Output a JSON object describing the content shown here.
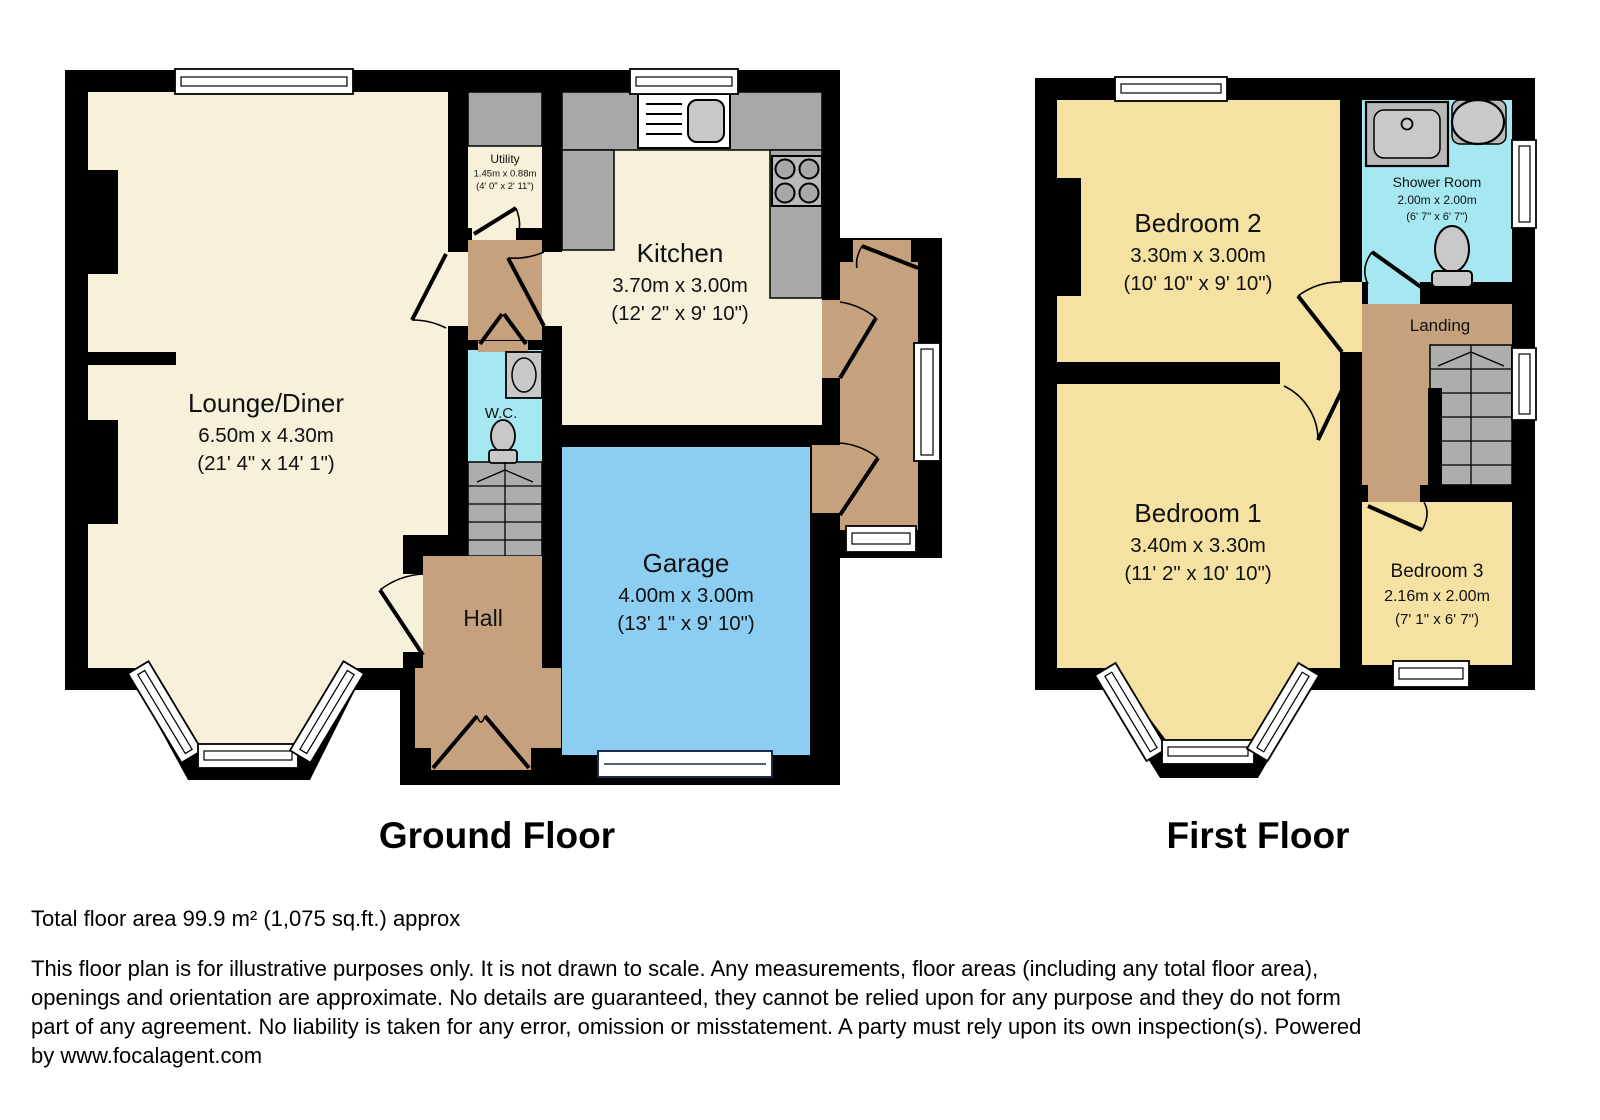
{
  "floors": {
    "ground": {
      "title": "Ground Floor",
      "rooms": {
        "lounge": {
          "name": "Lounge/Diner",
          "metric": "6.50m x 4.30m",
          "imperial": "(21' 4\" x 14' 1\")"
        },
        "utility": {
          "name": "Utility",
          "metric": "1.45m x 0.88m",
          "imperial": "(4' 0\" x 2' 11\")"
        },
        "kitchen": {
          "name": "Kitchen",
          "metric": "3.70m x 3.00m",
          "imperial": "(12' 2\" x 9' 10\")"
        },
        "wc": {
          "name": "W.C."
        },
        "hall": {
          "name": "Hall"
        },
        "garage": {
          "name": "Garage",
          "metric": "4.00m x 3.00m",
          "imperial": "(13' 1\" x 9' 10\")"
        }
      }
    },
    "first": {
      "title": "First Floor",
      "rooms": {
        "bedroom2": {
          "name": "Bedroom 2",
          "metric": "3.30m x 3.00m",
          "imperial": "(10' 10\" x 9' 10\")"
        },
        "shower": {
          "name": "Shower Room",
          "metric": "2.00m x 2.00m",
          "imperial": "(6' 7\" x 6' 7\")"
        },
        "landing": {
          "name": "Landing"
        },
        "bedroom1": {
          "name": "Bedroom 1",
          "metric": "3.40m x 3.30m",
          "imperial": "(11' 2\" x 10' 10\")"
        },
        "bedroom3": {
          "name": "Bedroom 3",
          "metric": "2.16m x 2.00m",
          "imperial": "(7' 1\" x 6' 7\")"
        }
      }
    }
  },
  "footer": {
    "total_area": "Total floor area 99.9 m² (1,075 sq.ft.) approx",
    "disclaimer_lines": [
      "This floor plan is for illustrative purposes only. It is not drawn to scale. Any measurements, floor areas (including any total floor area),",
      "openings and orientation are approximate. No details are guaranteed, they cannot be relied upon for any purpose and they do not form",
      "part of any agreement. No liability is taken for any error, omission or misstatement. A party must rely upon its own inspection(s). Powered",
      "by www.focalagent.com"
    ]
  },
  "colors": {
    "wall": "#000000",
    "room_cream": "#F7F0DA",
    "room_yellow": "#F5E2A2",
    "hall_tan": "#C5A27D",
    "garage_blue": "#8BCEF2",
    "bath_cyan": "#A5E8F2",
    "counter_gray": "#A8A8A8",
    "fixture_gray": "#C8C8C8",
    "stair_gray": "#ADADAD"
  }
}
